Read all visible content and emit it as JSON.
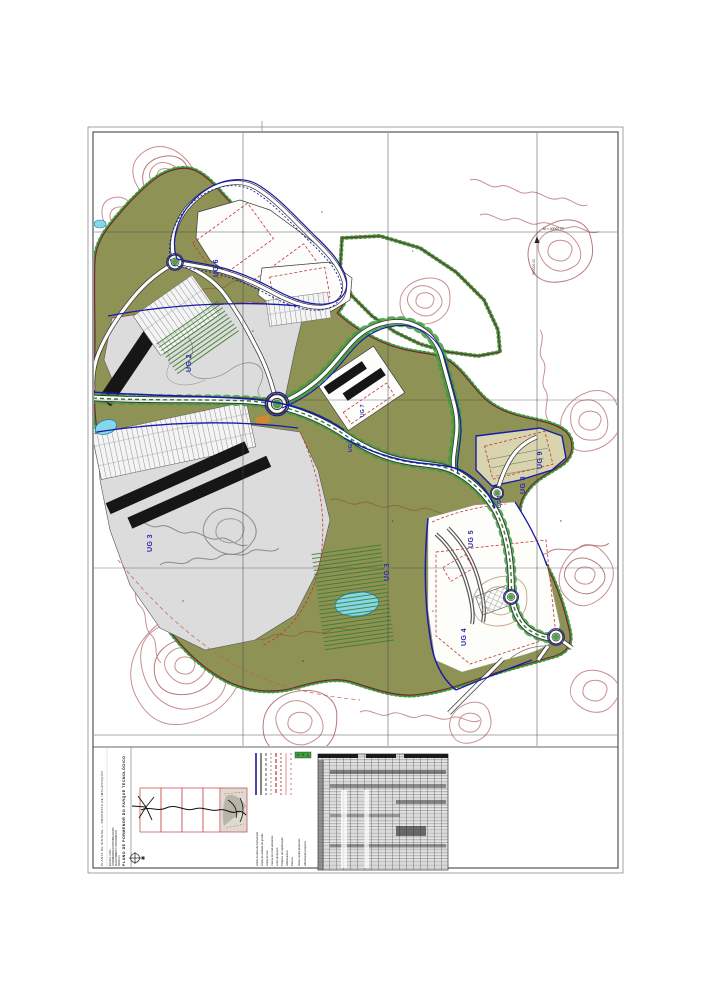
{
  "sheet": {
    "titleblock": {
      "title_line1": "PLANO DE PORMENOR DO PARQUE TECNOLÓGICO",
      "title_line2": "PLANTA DE SÍNTESE — PROPOSTA DE IMPLANTAÇÃO",
      "spec_lines": [
        "ESCALA 1:2000",
        "COORDENADAS HAYFORD-GAUSS",
        "LEVANTAMENTO TOPOGRÁFICO",
        "FOLHA 01"
      ]
    },
    "legend": {
      "items": [
        {
          "color": "#1a1aa8",
          "dash": "200",
          "width": "1.6",
          "label": "Limite da área de intervenção"
        },
        {
          "color": "#222222",
          "dash": "200",
          "width": "1.1",
          "label": "Limite de unidade de gestão"
        },
        {
          "color": "#444444",
          "dash": "3 2",
          "width": "0.9",
          "label": "Limite de lote"
        },
        {
          "color": "#8a8a8a",
          "dash": "2 2",
          "width": "0.9",
          "label": "Curvas de nível existentes"
        },
        {
          "color": "#c23333",
          "dash": "4 2",
          "width": "1.2",
          "label": "Lotes propostos"
        },
        {
          "color": "#c23333",
          "dash": "2 2",
          "width": "0.9",
          "label": "Polígono de implantação"
        },
        {
          "color": "#d06666",
          "dash": "200",
          "width": "0.7",
          "label": "Alinhamentos"
        },
        {
          "color": "#d06666",
          "dash": "2 3",
          "width": "0.9",
          "label": "Recuos"
        }
      ],
      "area_items": [
        {
          "label": "Áreas verdes propostas"
        },
        {
          "label": "Arborização proposta"
        }
      ],
      "swatch_color": "#3f9b3f"
    }
  },
  "map": {
    "labels": [
      {
        "text": "UG 6"
      },
      {
        "text": "UG 2"
      },
      {
        "text": "UG 3"
      },
      {
        "text": "UG 3"
      },
      {
        "text": "UG 5"
      },
      {
        "text": "UG 4"
      },
      {
        "text": "UG 9"
      },
      {
        "text": "UG 8"
      },
      {
        "text": "UG 1"
      },
      {
        "text": "UG 7"
      },
      {
        "text": "UG 1"
      }
    ],
    "coordinates": {
      "easting": "M = 40000.00",
      "northing": "300000.00"
    },
    "numbers": [
      "2",
      "3",
      "1",
      "2",
      "3",
      "5",
      "1",
      "3"
    ]
  }
}
